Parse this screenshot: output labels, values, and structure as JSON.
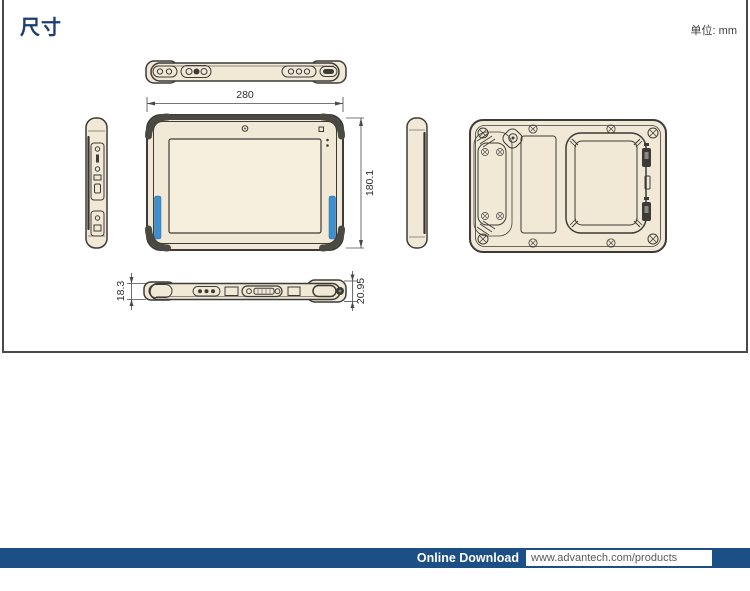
{
  "page": {
    "title": "尺寸",
    "unit_label": "单位: mm"
  },
  "drawing": {
    "dimensions": {
      "width_mm": "280",
      "height_mm": "180.1",
      "thickness_left_mm": "18.3",
      "thickness_right_mm": "20.95"
    }
  },
  "footer": {
    "download_label": "Online Download",
    "url": "www.advantech.com/products"
  },
  "colors": {
    "title_navy": "#1C3E6E",
    "footer_navy": "#1B4F85",
    "accent_blue": "#3D8FCE",
    "body_cream": "#F1E9D6",
    "screen_cream": "#F6EFDD",
    "outline_dark": "#3C3B38"
  }
}
